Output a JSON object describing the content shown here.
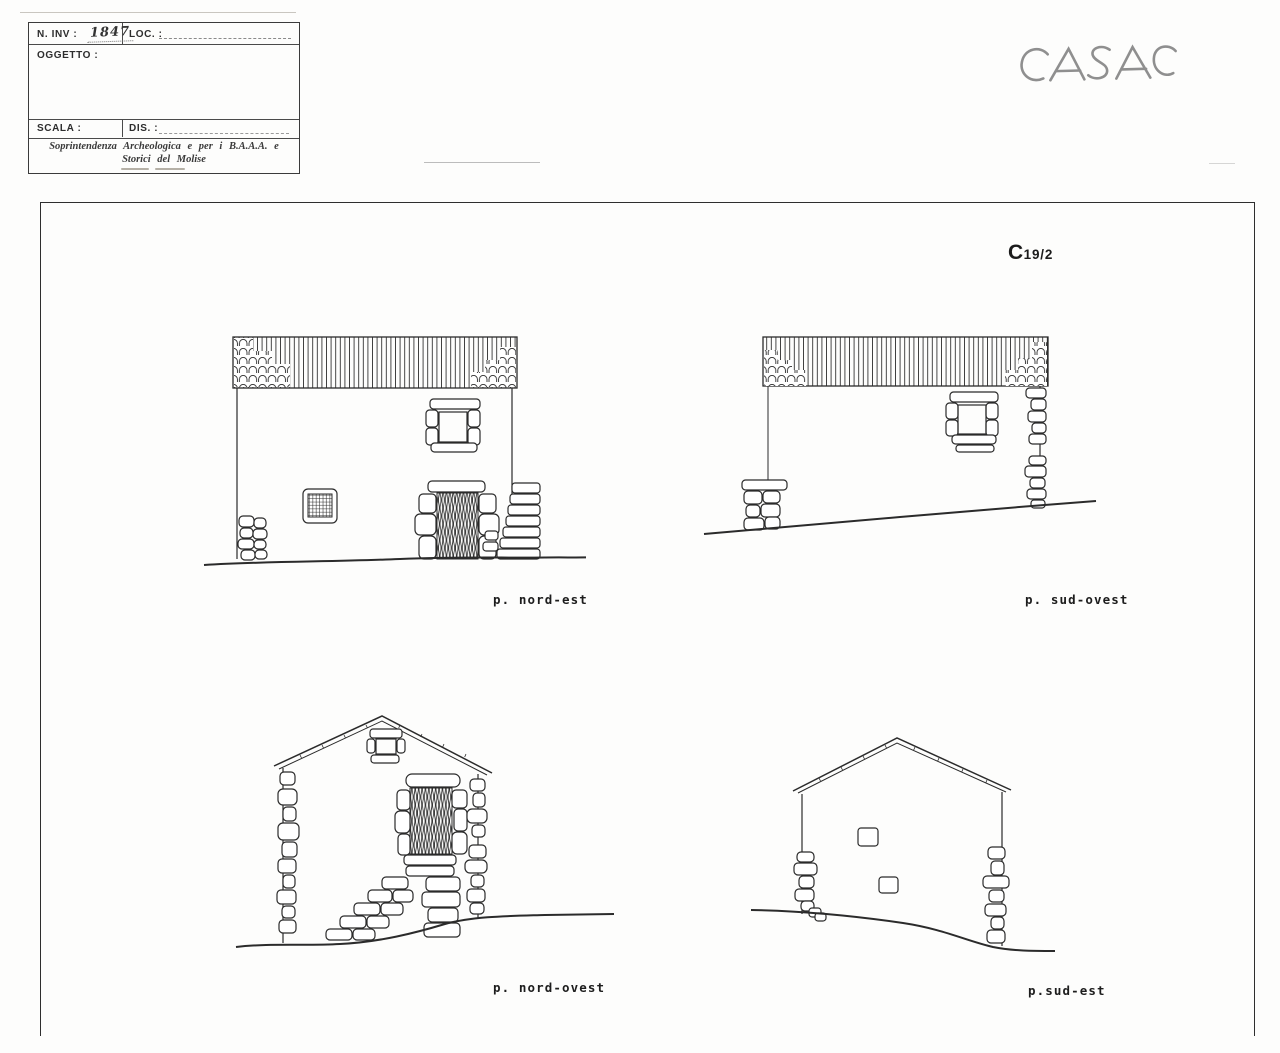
{
  "title_block": {
    "inv_label": "N. INV :",
    "inv_value": "1847",
    "loc_label": "LOC. :",
    "oggetto_label": "OGGETTO :",
    "scala_label": "SCALA :",
    "dis_label": "DIS. :",
    "institution_line1": "Soprintendenza Archeologica e per i B.A.A.A. e",
    "institution_line2": "Storici del Molise"
  },
  "handwritten_note": "CASA C",
  "sheet_ref": {
    "letter": "C",
    "number": "19/2"
  },
  "elevations": {
    "nord_est": {
      "label": "p. nord-est"
    },
    "sud_ovest": {
      "label": "p. sud-ovest"
    },
    "nord_ovest": {
      "label": "p. nord-ovest"
    },
    "sud_est": {
      "label": "p.sud-est"
    }
  },
  "colors": {
    "ink": "#2b2b2b",
    "pencil": "#8f8f8f",
    "paper": "#fdfdfc"
  }
}
